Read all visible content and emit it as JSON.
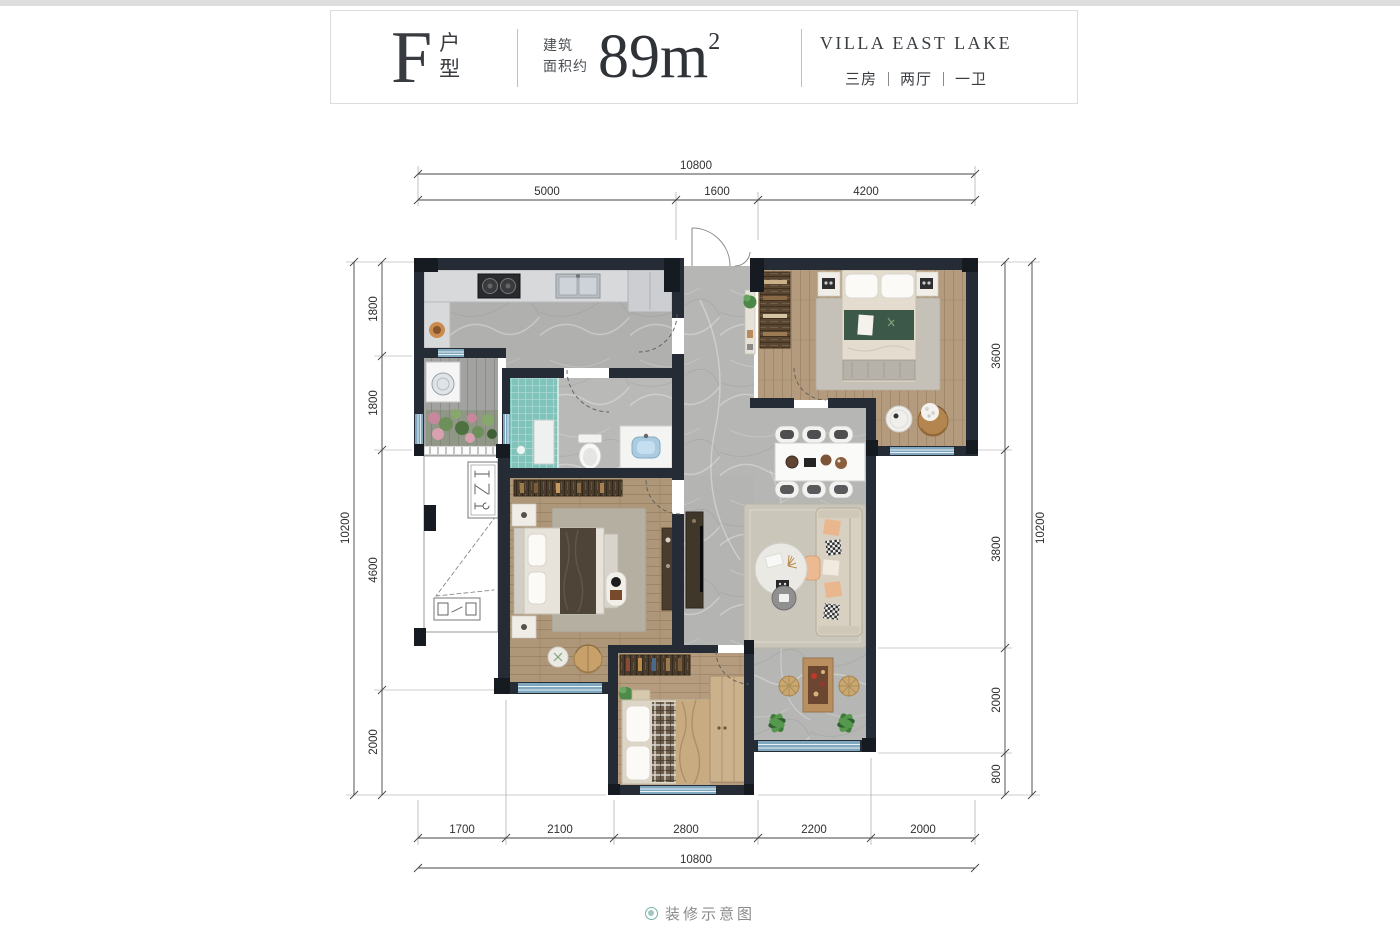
{
  "header": {
    "unit_letter": "F",
    "unit_label_chars": [
      "户",
      "型"
    ],
    "area_prefix": [
      "建筑",
      "面积约"
    ],
    "area_value": "89m",
    "area_exponent": "2",
    "project_name": "VILLA EAST LAKE",
    "layout_spec": [
      "三房",
      "两厅",
      "一卫"
    ]
  },
  "dimensions": {
    "top": {
      "total": "10800",
      "segments": [
        "5000",
        "1600",
        "4200"
      ]
    },
    "bottom": {
      "total": "10800",
      "segments": [
        "1700",
        "2100",
        "2800",
        "2200",
        "2000"
      ]
    },
    "left": {
      "total": "10200",
      "segments": [
        "1800",
        "1800",
        "4600",
        "2000"
      ]
    },
    "right": {
      "total": "10200",
      "segments": [
        "3600",
        "3800",
        "2000",
        "800"
      ]
    }
  },
  "footer": {
    "caption": "装修示意图"
  },
  "colors": {
    "wall": "#262c35",
    "column": "#161b22",
    "window_glass": "#7fa8bf",
    "marble_floor": "#b3b3b1",
    "wood_floor": "#b49b7d",
    "teal_tile": "#7fc3ba",
    "accent_teal": "#76b0a7"
  }
}
